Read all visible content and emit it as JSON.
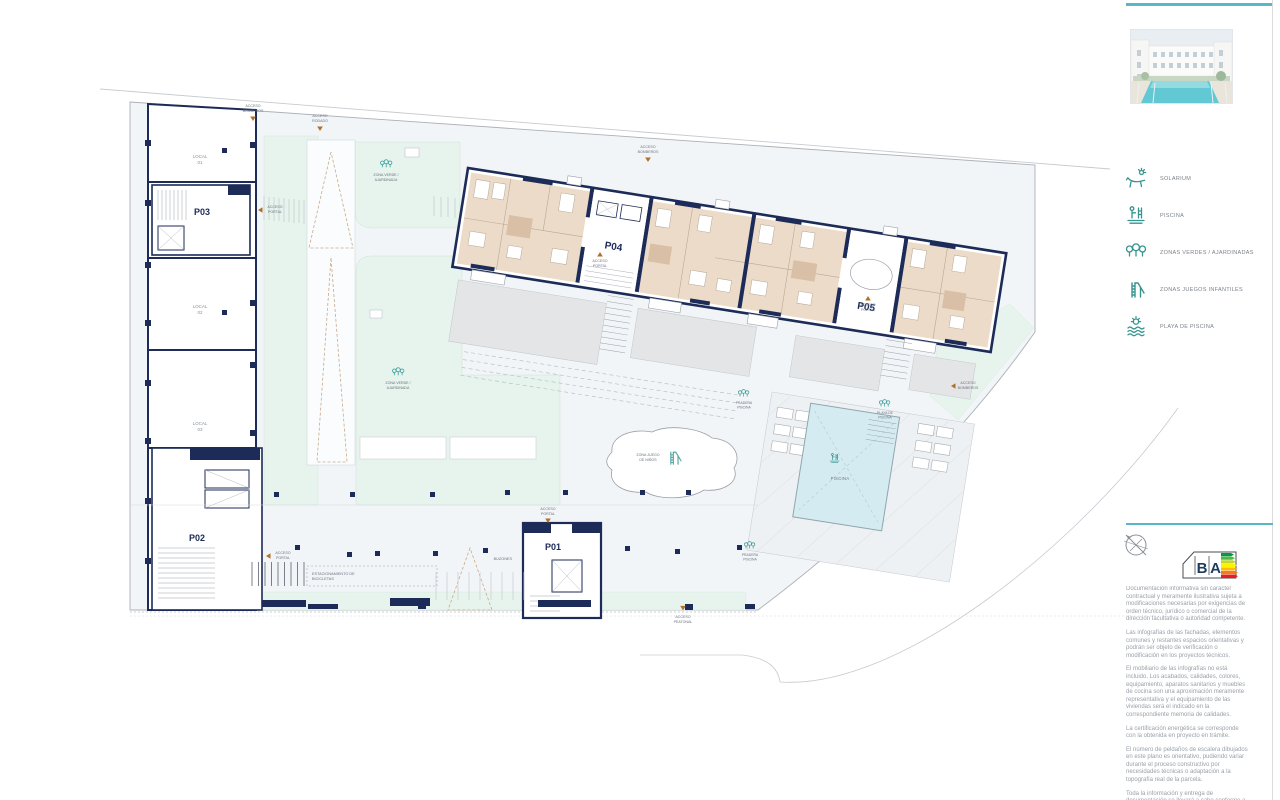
{
  "colors": {
    "teal_accent": "#36948f",
    "rule_teal": "#57b7c7",
    "wall_navy": "#1c2b57",
    "apartment_beige": "#ecdbc8",
    "bath_beige": "#d9bfa5",
    "green_zone": "#e7f3ed",
    "pool_blue": "#d4ebf2",
    "terrace_gray": "#e4e5e7",
    "access_arrow_orange": "#b0702a"
  },
  "plan": {
    "portals": {
      "p01": "P01",
      "p02": "P02",
      "p03": "P03",
      "p04": "P04",
      "p05": "P05"
    },
    "local_label": "LOCAL",
    "local_numbers": [
      "01",
      "02",
      "03"
    ],
    "access": {
      "acceso": "ACCESO",
      "bomberos": "BOMBEROS",
      "rodado": "RODADO",
      "portal": "PORTAL",
      "peatonal": "PEATONAL"
    },
    "areas": {
      "zona_verde_l1": "ZONA VERDE /",
      "zona_verde_l2": "AJARDINADA",
      "zona_juegos_l1": "ZONA JUEGO",
      "zona_juegos_l2": "DE NIÑOS",
      "piscina": "PISCINA",
      "playa_l1": "PLAYA DE",
      "playa_l2": "PISCINA",
      "pradera_l1": "PRADERA",
      "pradera_l2": "PISCINA",
      "buzones": "BUZONES",
      "bici_l1": "ESTACIONAMIENTO DE",
      "bici_l2": "BICICLETAS"
    }
  },
  "legend": {
    "items": [
      {
        "icon": "sun-lounger-icon",
        "label": "SOLARIUM"
      },
      {
        "icon": "pool-ladder-icon",
        "label": "PISCINA"
      },
      {
        "icon": "trees-icon",
        "label": "ZONAS VERDES / AJARDINADAS"
      },
      {
        "icon": "slide-icon",
        "label": "ZONAS JUEGOS INFANTILES"
      },
      {
        "icon": "sun-waves-icon",
        "label": "PLAYA DE PISCINA"
      }
    ]
  },
  "energy": {
    "letter_b": "B",
    "letter_a": "A"
  },
  "disclaimer": {
    "paragraphs": [
      "Documentación informativa sin carácter contractual y meramente ilustrativa sujeta a modificaciones necesarias por exigencias de orden técnico, jurídico o comercial de la dirección facultativa o autoridad competente.",
      "Las infografías de las fachadas, elementos comunes y restantes espacios orientativas y podrán ser objeto de verificación o modificación en los proyectos técnicos.",
      "El mobiliario de las infografías no está incluido. Los acabados, calidades, colores, equipamiento, aparatos sanitarios y muebles de cocina son una aproximación meramente representativa y el equipamiento de las viviendas será el indicado en la correspondiente memoria de calidades.",
      "La certificación energética se corresponde con la obtenida en proyecto en trámite.",
      "El número de peldaños de escalera dibujados en este plano es orientativo, pudiendo variar durante el proceso constructivo por necesidades técnicas o adaptación a la topografía real de la parcela.",
      "Toda la información y entrega de documentación se llevará a cabo conforme a lo dispuesto en el Real Decreto 515/1989 y demás normas que pudieran aplicar."
    ]
  }
}
